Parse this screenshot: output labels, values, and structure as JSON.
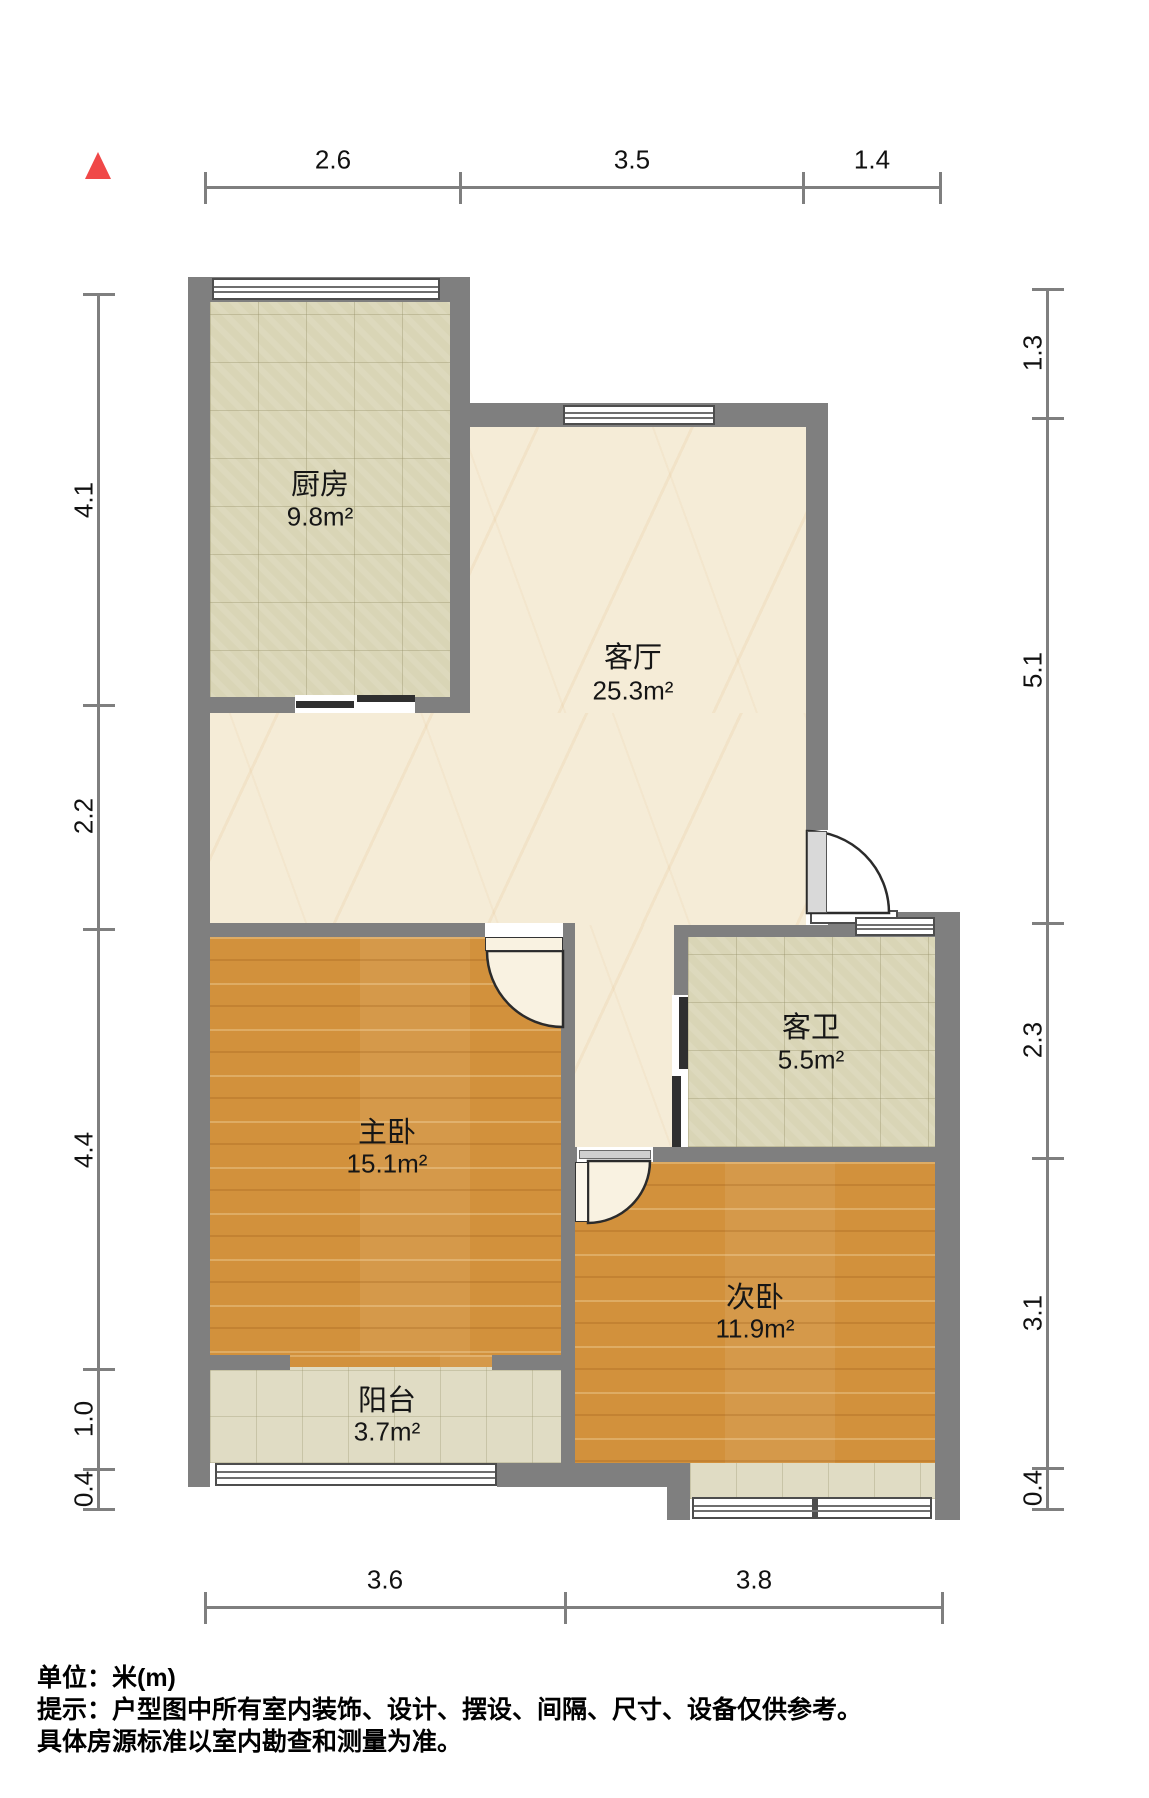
{
  "plan": {
    "type": "apartment-floor-plan",
    "compass": "north-arrow",
    "rooms": [
      {
        "id": "kitchen",
        "name": "厨房",
        "area": "9.8m²"
      },
      {
        "id": "living",
        "name": "客厅",
        "area": "25.3m²"
      },
      {
        "id": "bathroom",
        "name": "客卫",
        "area": "5.5m²"
      },
      {
        "id": "master",
        "name": "主卧",
        "area": "15.1m²"
      },
      {
        "id": "second",
        "name": "次卧",
        "area": "11.9m²"
      },
      {
        "id": "balcony",
        "name": "阳台",
        "area": "3.7m²"
      }
    ],
    "dimensions": {
      "top": [
        "2.6",
        "3.5",
        "1.4"
      ],
      "bottom": [
        "3.6",
        "3.8"
      ],
      "left": [
        "4.1",
        "2.2",
        "4.4",
        "1.0",
        "0.4"
      ],
      "right": [
        "1.3",
        "5.1",
        "2.3",
        "3.1",
        "0.4"
      ]
    },
    "colors": {
      "wall": "#7f7f7f",
      "north_arrow": "#f04848",
      "tile_floor": "#d9d5b6",
      "marble_floor": "#f5ecd7",
      "wood_floor": "#d2913c"
    }
  },
  "footer": {
    "line1": "单位：米(m)",
    "line2": "提示：户型图中所有室内装饰、设计、摆设、间隔、尺寸、设备仅供参考。",
    "line3": "具体房源标准以室内勘查和测量为准。"
  }
}
